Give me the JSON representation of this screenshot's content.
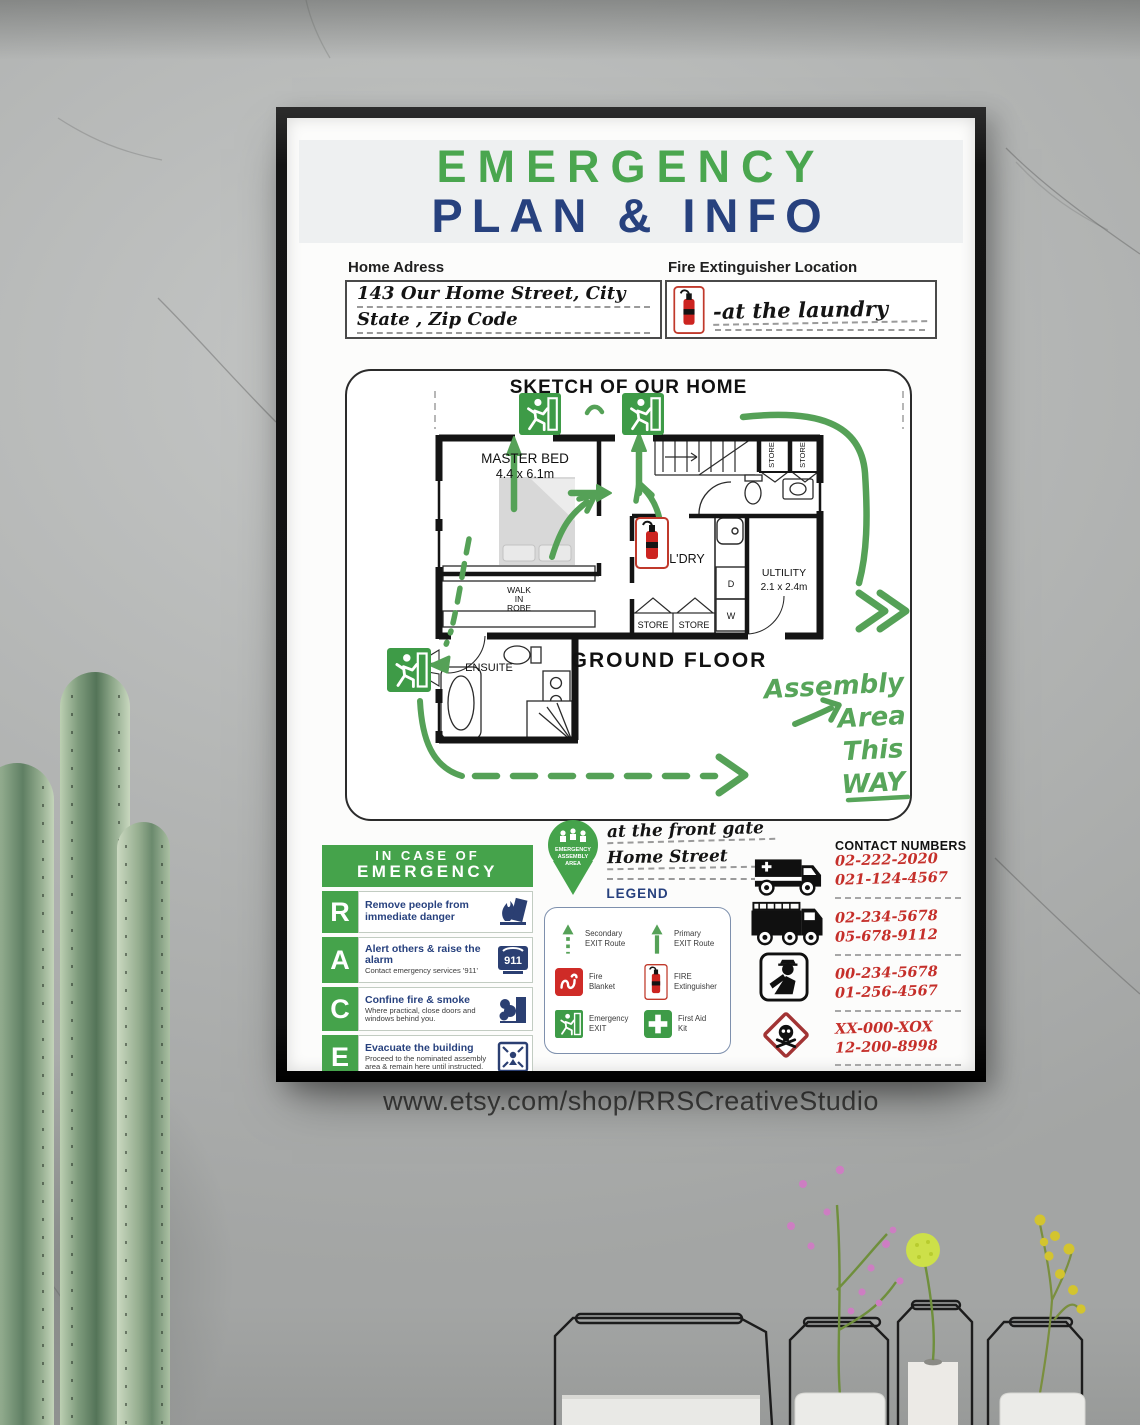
{
  "scene": {
    "caption": "www.etsy.com/shop/RRSCreativeStudio"
  },
  "colors": {
    "green": "#45a34b",
    "navy": "#27417e",
    "red": "#c52f2a",
    "arrow_green": "#55a157"
  },
  "poster": {
    "title": {
      "line1": "EMERGENCY",
      "line2": "PLAN & INFO"
    },
    "address": {
      "label": "Home Adress",
      "line1": "143 Our Home Street, City",
      "line2": "State , Zip Code"
    },
    "extinguisher": {
      "label": "Fire Extinguisher Location",
      "value": "-at the laundry"
    },
    "sketch": {
      "title": "SKETCH OF OUR HOME",
      "rooms": {
        "master_bed": {
          "name": "MASTER BED",
          "size": "4.4 x 6.1m"
        },
        "walk_in_robe": [
          "WALK",
          "IN",
          "ROBE"
        ],
        "ensuite": "ENSUITE",
        "laundry": "L'DRY",
        "utility": {
          "name": "ULTILITY",
          "size": "2.1 x 2.4m"
        },
        "store_top_1": "STORE",
        "store_top_2": "STORE",
        "store_bottom_1": "STORE",
        "store_bottom_2": "STORE",
        "dryer": "D",
        "washer": "W",
        "floor_label": "GROUND FLOOR"
      },
      "assembly_note": [
        "Assembly",
        "Area",
        "This",
        "WAY"
      ]
    },
    "race": {
      "header_line1": "IN CASE OF",
      "header_line2": "EMERGENCY",
      "nine_one_one": "911",
      "items": [
        {
          "letter": "R",
          "title": "Remove people from immediate danger",
          "desc": ""
        },
        {
          "letter": "A",
          "title": "Alert others & raise the alarm",
          "desc": "Contact emergency services '911'"
        },
        {
          "letter": "C",
          "title": "Confine fire & smoke",
          "desc": "Where practical, close doors and windows behind you."
        },
        {
          "letter": "E",
          "title": "Evacuate the building",
          "desc": "Proceed to the nominated assembly area & remain here until instructed."
        }
      ]
    },
    "assembly": {
      "line1": "EMERGENCY",
      "line2": "ASSEMBLY",
      "line3": "AREA",
      "note1": "at the front gate",
      "note2": "Home Street"
    },
    "legend": {
      "title": "LEGEND",
      "items": [
        {
          "line1": "Secondary",
          "line2": "EXIT Route"
        },
        {
          "line1": "Primary",
          "line2": "EXIT Route"
        },
        {
          "line1": "Fire",
          "line2": "Blanket"
        },
        {
          "line1": "FIRE",
          "line2": "Extinguisher"
        },
        {
          "line1": "Emergency",
          "line2": "EXIT"
        },
        {
          "line1": "First Aid",
          "line2": "Kit"
        }
      ]
    },
    "contacts": {
      "header": "CONTACT NUMBERS",
      "groups": [
        {
          "line1": "02-222-2020",
          "line2": "021-124-4567"
        },
        {
          "line1": "02-234-5678",
          "line2": "05-678-9112"
        },
        {
          "line1": "00-234-5678",
          "line2": "01-256-4567"
        },
        {
          "line1": "XX-000-XOX",
          "line2": "12-200-8998"
        }
      ]
    }
  }
}
